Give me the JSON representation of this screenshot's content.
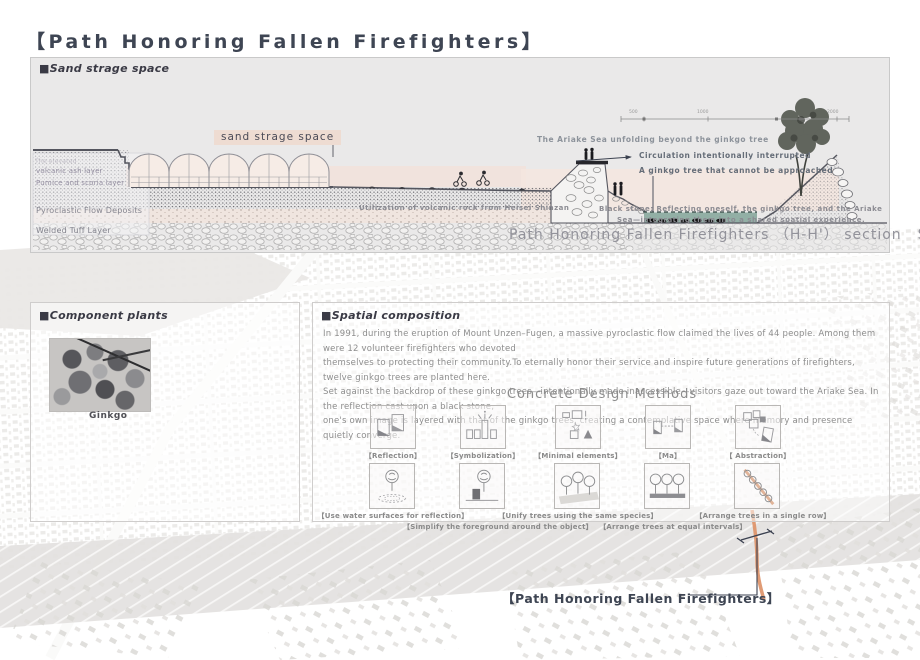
{
  "title": "【Path Honoring Fallen Firefighters】",
  "section": {
    "header": "■Sand strage space",
    "sand_label": "sand strage space",
    "geology_labels": [
      "The elevated",
      "volcanic ash layer",
      "Pumice and scoria layer",
      "Pyroclastic Flow Deposits",
      "Welded Tuff Layer"
    ],
    "annotations": {
      "ariake_unfolding": "The Ariake Sea unfolding beyond the ginkgo tree",
      "circulation": "Circulation intentionally interrupted",
      "ginkgo_tree": "A ginkgo tree that cannot be approached",
      "volcanic_rock": "Utilization of volcanic rock from Heisei Shinzan",
      "black_stone_1": "Black stone: Reflecting oneself, the ginkgo tree, and the Ariake",
      "black_stone_2": "Sea—integrating them into a shared spatial experience."
    },
    "scale_ticks": [
      "500",
      "1000",
      "2000"
    ],
    "caption": "Path Honoring Fallen Firefighters （H-H'） section",
    "caption_scale": "S=1:300"
  },
  "component_plants": {
    "header": "■Component plants",
    "caption": "Ginkgo"
  },
  "spatial_composition": {
    "header": "■Spatial composition",
    "paragraph": "In 1991, during the eruption of Mount Unzen–Fugen, a massive pyroclastic flow claimed the lives of 44 people. Among them were 12 volunteer firefighters who devoted\nthemselves to protecting their community.To eternally honor their service and inspire future generations of firefighters, twelve ginkgo trees are planted here.\nSet against the backdrop of these ginkgo trees—intentionally made inaccessible—visitors gaze out toward the Ariake Sea. In the reflection cast upon a black stone,\none's own image is layered with that of the ginkgo trees, creating a contemplative space where memory and presence quietly converge.",
    "methods_title": "Concrete Design Methods",
    "methods_row1": [
      {
        "label": "【Reflection】",
        "icon": "reflection-icon"
      },
      {
        "label": "【Symbolization】",
        "icon": "symbolization-icon"
      },
      {
        "label": "【Minimal elements】",
        "icon": "minimal-elements-icon"
      },
      {
        "label": "【Ma】",
        "icon": "ma-icon"
      },
      {
        "label": "【 Abstraction】",
        "icon": "abstraction-icon"
      }
    ],
    "methods_row2": [
      {
        "label": "【Use water surfaces for reflection】",
        "icon": "water-reflection-icon"
      },
      {
        "label": "【Simplify the foreground around the object】",
        "icon": "simplify-foreground-icon"
      },
      {
        "label": "【Unify trees using the same species】",
        "icon": "same-species-icon"
      },
      {
        "label": "【Arrange trees at equal intervals】",
        "icon": "equal-intervals-icon"
      },
      {
        "label": "【Arrange trees in a single row】",
        "icon": "single-row-icon"
      }
    ]
  },
  "map": {
    "site_label": "【Path Honoring Fallen Firefighters】"
  },
  "colors": {
    "title": "#3e4553",
    "panel_bg": "#eae9e9",
    "pink_band": "#f2e2da",
    "pond": "#92afa5",
    "orange_path": "#dd9066",
    "annotation_gray": "#8b8b92"
  }
}
